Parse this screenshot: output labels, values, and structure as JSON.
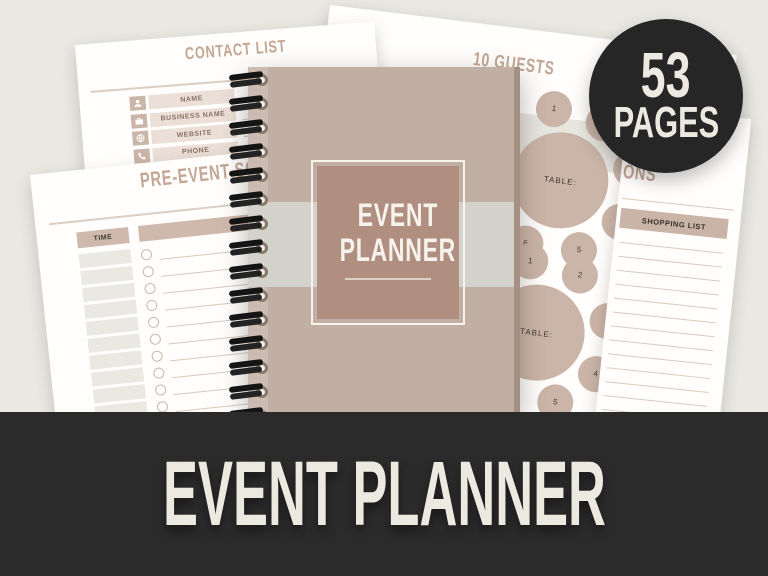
{
  "background_color": "#e9e8e2",
  "colors": {
    "accent_tan_text": "#c3a694",
    "tan_fill": "#cbb5a8",
    "banner_bg": "#2b2b2b",
    "badge_bg": "#262626",
    "off_white_text": "#ece9e1",
    "cover_bg": "#c2afa4",
    "cover_band": "#d4d3cb",
    "cover_square": "#b08f80"
  },
  "banner": {
    "title": "EVENT PLANNER"
  },
  "badge": {
    "count": "53",
    "label": "PAGES"
  },
  "cover": {
    "title_lines": [
      "EVENT",
      "PLANNER"
    ]
  },
  "contact_page": {
    "title": "CONTACT LIST",
    "rows": [
      {
        "icon": "person-icon",
        "label": "NAME"
      },
      {
        "icon": "briefcase-icon",
        "label": "BUSINESS NAME"
      },
      {
        "icon": "globe-icon",
        "label": "WEBSITE"
      },
      {
        "icon": "phone-icon",
        "label": "PHONE"
      },
      {
        "icon": "envelope-icon",
        "label": "EMAIL"
      }
    ]
  },
  "guests_page": {
    "title": "10 GUESTS",
    "tables": [
      {
        "label": "TABLE:",
        "seats": [
          "1",
          "2",
          "3",
          "4",
          "5",
          "6"
        ]
      },
      {
        "label": "TABLE:",
        "seats": [
          "1",
          "2",
          "3",
          "4",
          "5",
          "6"
        ]
      }
    ]
  },
  "schedule_page": {
    "title": "PRE-EVENT SCHEDULE",
    "col_time": "TIME",
    "col_task": "TASK",
    "row_count": 13
  },
  "shopping_page": {
    "visible_title": "ONS",
    "list_title": "SHOPPING LIST",
    "line_count": 13
  },
  "spiral": {
    "ring_count": 15
  }
}
